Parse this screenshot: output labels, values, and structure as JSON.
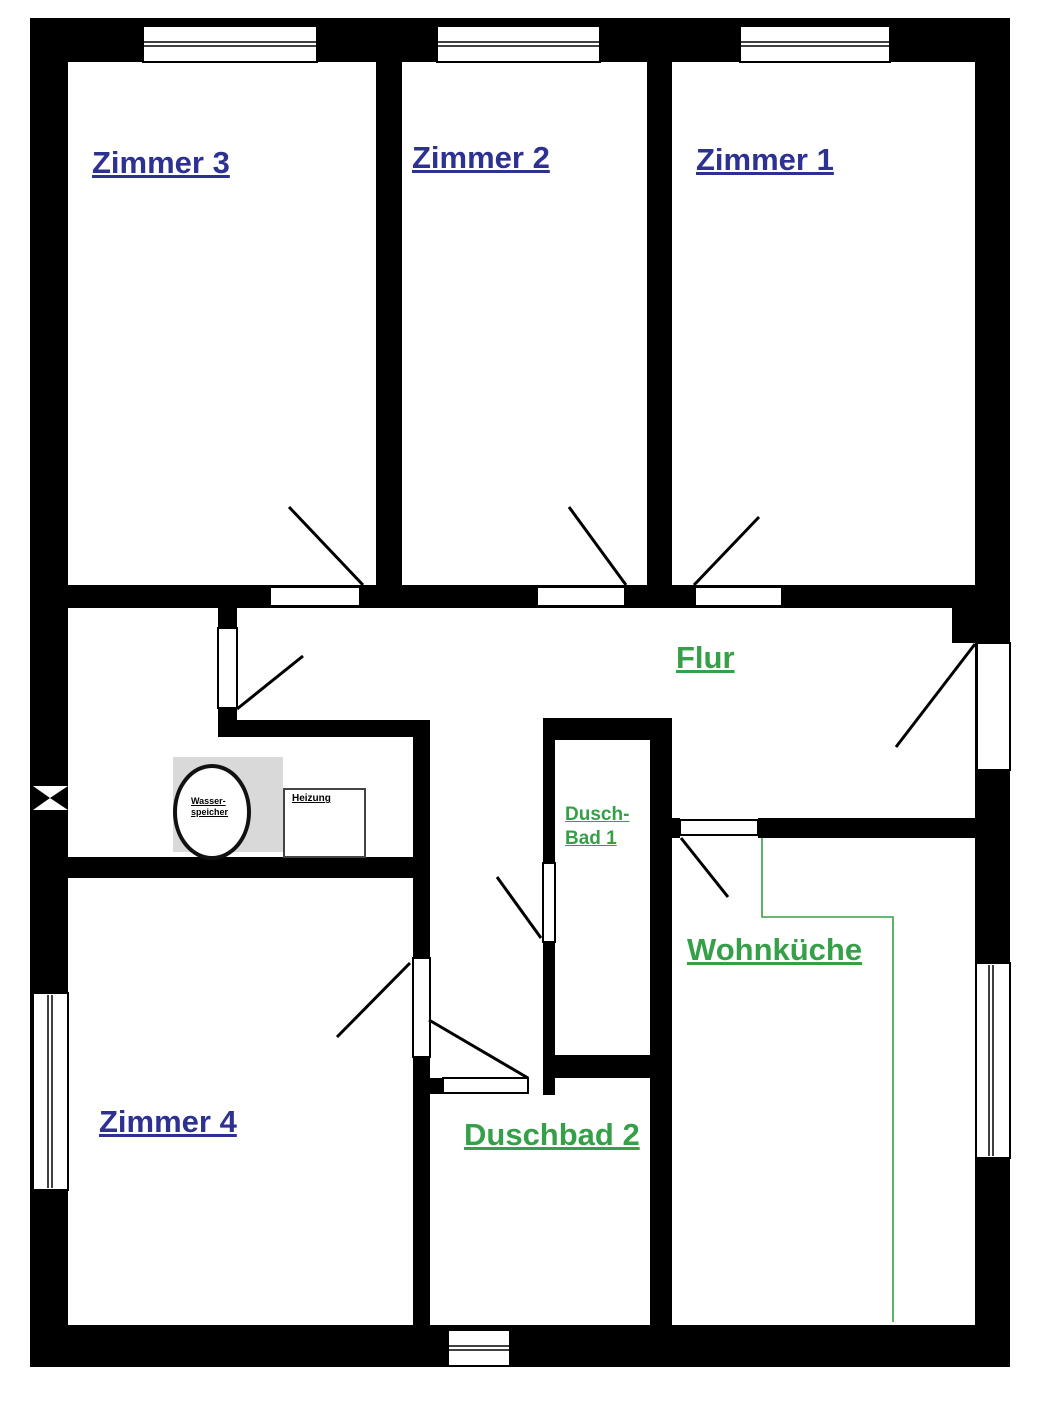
{
  "labels": {
    "zimmer1": "Zimmer 1",
    "zimmer2": "Zimmer 2",
    "zimmer3": "Zimmer 3",
    "zimmer4": "Zimmer 4",
    "flur": "Flur",
    "duschbad1_line1": "Dusch-",
    "duschbad1_line2": "Bad 1",
    "duschbad2": "Duschbad 2",
    "wohnkueche": "Wohnküche",
    "wasserspeicher_line1": "Wasser-",
    "wasserspeicher_line2": "speicher",
    "heizung": "Heizung"
  },
  "colors": {
    "room_label": "#2d3191",
    "area_label": "#35a047",
    "wall": "#000000",
    "utility_area_bg": "#d9d9d9",
    "kitchen_outline": "#35a047"
  }
}
